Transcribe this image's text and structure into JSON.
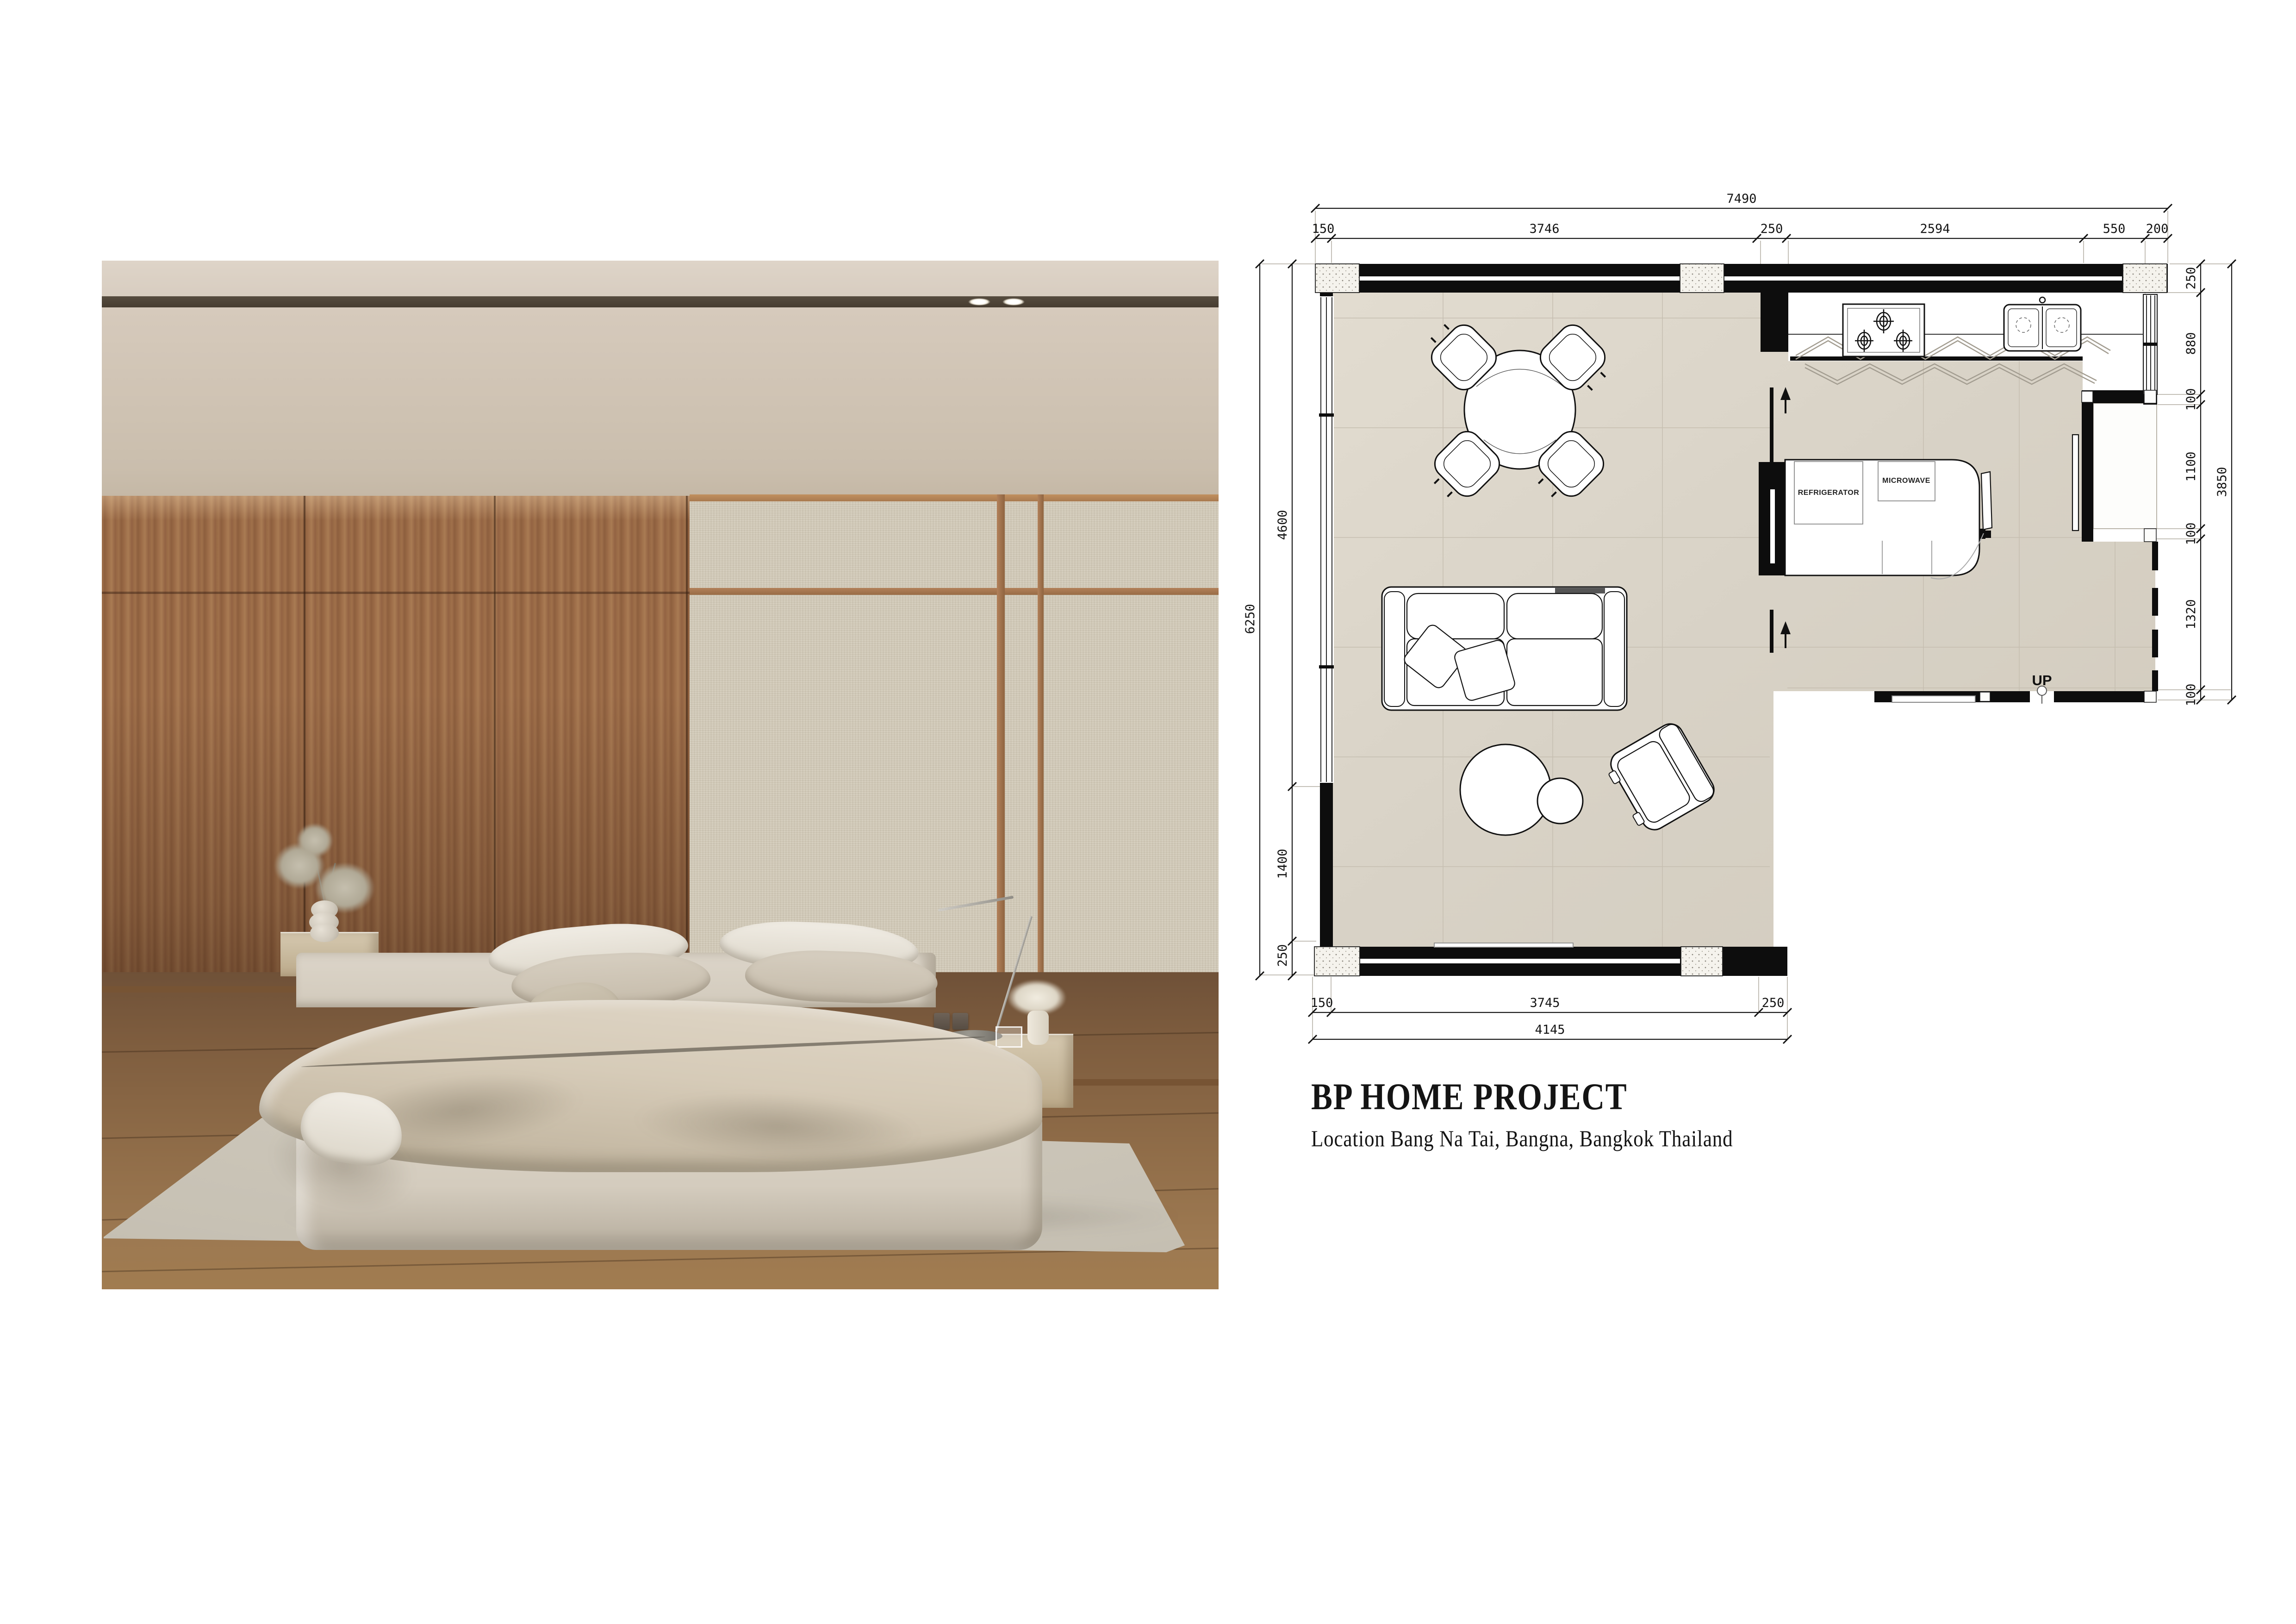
{
  "document": {
    "background": "#ffffff"
  },
  "title_block": {
    "heading": "BP HOME PROJECT",
    "subheading": "Location Bang Na Tai, Bangna, Bangkok Thailand"
  },
  "floor_plan": {
    "room_labels": {
      "refrigerator": "REFRIGERATOR",
      "microwave": "MICROWAVE",
      "up": "UP"
    },
    "dimensions": {
      "top_total": "7490",
      "top_segments": [
        "150",
        "3746",
        "250",
        "2594",
        "550",
        "200"
      ],
      "left_total": "6250",
      "left_segments": [
        "4600",
        "1400",
        "250"
      ],
      "right_total": "3850",
      "right_segments": [
        "250",
        "880",
        "100",
        "1100",
        "100",
        "1320",
        "100"
      ],
      "bottom_total": "4145",
      "bottom_segments": [
        "150",
        "3745",
        "250"
      ]
    },
    "colors": {
      "wall": "#0d0d0d",
      "tile_floor": "#d9d3c7",
      "column_fill": "#f5f3ed"
    }
  },
  "photo": {
    "colors": {
      "wood_panel": "#9a6a46",
      "fabric_panel": "#d3cbb9",
      "ceiling": "#d9cfc3",
      "track_recess": "#4a4034",
      "floor_wood": "#8c6a47",
      "bedding": "#d6cdbd",
      "rug": "#c9c4b8"
    }
  }
}
